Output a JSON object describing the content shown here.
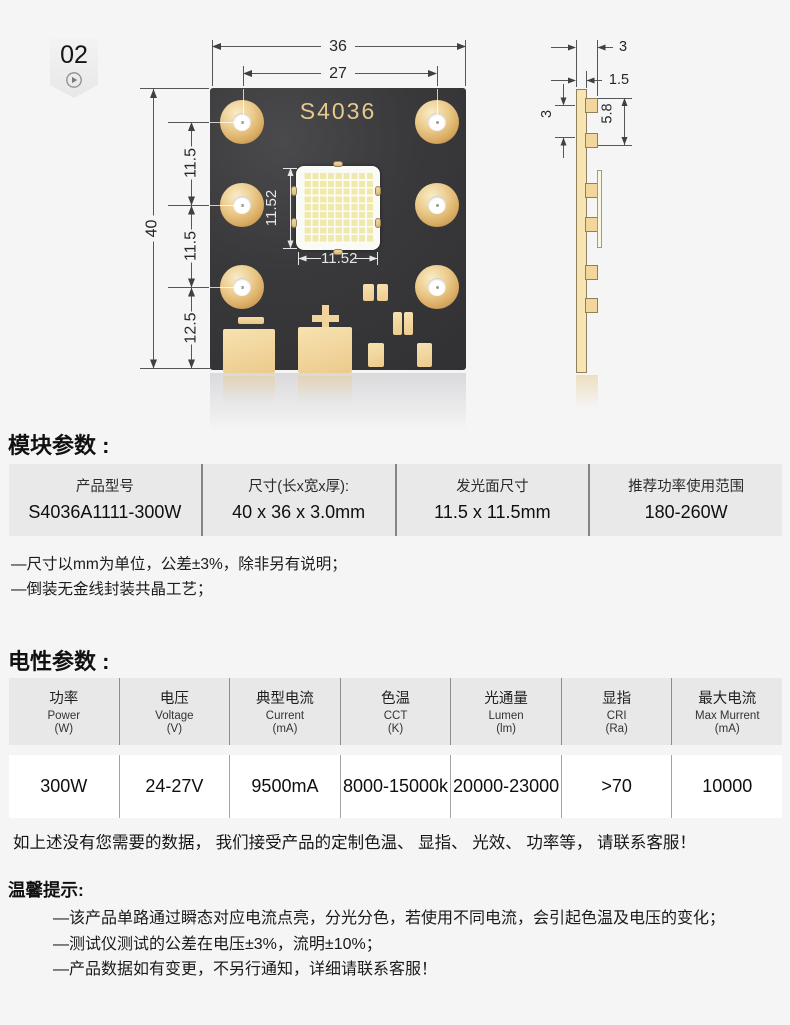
{
  "badge": {
    "number": "02"
  },
  "front_view": {
    "board_label": "S4036",
    "dim_overall_width": "36",
    "dim_hole_pitch_h": "27",
    "dim_overall_height": "40",
    "dim_row_pitch_1": "11.5",
    "dim_row_pitch_2": "11.5",
    "dim_bottom_offset": "12.5",
    "dim_led_height": "11.52",
    "dim_led_width": "11.52"
  },
  "side_view": {
    "dim_thickness": "3",
    "dim_substrate": "1.5",
    "dim_pad_pitch": "3",
    "dim_led_zone": "5.8"
  },
  "module_section": {
    "title": "模块参数 :",
    "columns": [
      {
        "header": "产品型号",
        "value": "S4036A1111-300W"
      },
      {
        "header": "尺寸(长x宽x厚):",
        "value": "40 x 36 x 3.0mm"
      },
      {
        "header": "发光面尺寸",
        "value": "11.5 x 11.5mm"
      },
      {
        "header": "推荐功率使用范围",
        "value": "180-260W"
      }
    ],
    "notes": [
      "—尺寸以mm为单位，公差±3%，除非另有说明；",
      "—倒装无金线封装共晶工艺；"
    ]
  },
  "electrical_section": {
    "title": "电性参数 :",
    "columns": [
      {
        "cn": "功率",
        "en": "Power",
        "unit": "(W)",
        "value": "300W"
      },
      {
        "cn": "电压",
        "en": "Voltage",
        "unit": "(V)",
        "value": "24-27V"
      },
      {
        "cn": "典型电流",
        "en": "Current",
        "unit": "(mA)",
        "value": "9500mA"
      },
      {
        "cn": "色温",
        "en": "CCT",
        "unit": "(K)",
        "value": "8000-15000k"
      },
      {
        "cn": "光通量",
        "en": "Lumen",
        "unit": "(lm)",
        "value": "20000-23000"
      },
      {
        "cn": "显指",
        "en": "CRI",
        "unit": "(Ra)",
        "value": ">70"
      },
      {
        "cn": "最大电流",
        "en": "Max Murrent",
        "unit": "(mA)",
        "value": "10000"
      }
    ],
    "custom_note": "如上述没有您需要的数据， 我们接受产品的定制色温、 显指、 光效、 功率等， 请联系客服！"
  },
  "tips_section": {
    "title": "温馨提示:",
    "items": [
      "—该产品单路通过瞬态对应电流点亮，分光分色，若使用不同电流，会引起色温及电压的变化；",
      "—测试仪测试的公差在电压±3%，流明±10%；",
      "—产品数据如有变更，不另行通知，详细请联系客服！"
    ]
  }
}
